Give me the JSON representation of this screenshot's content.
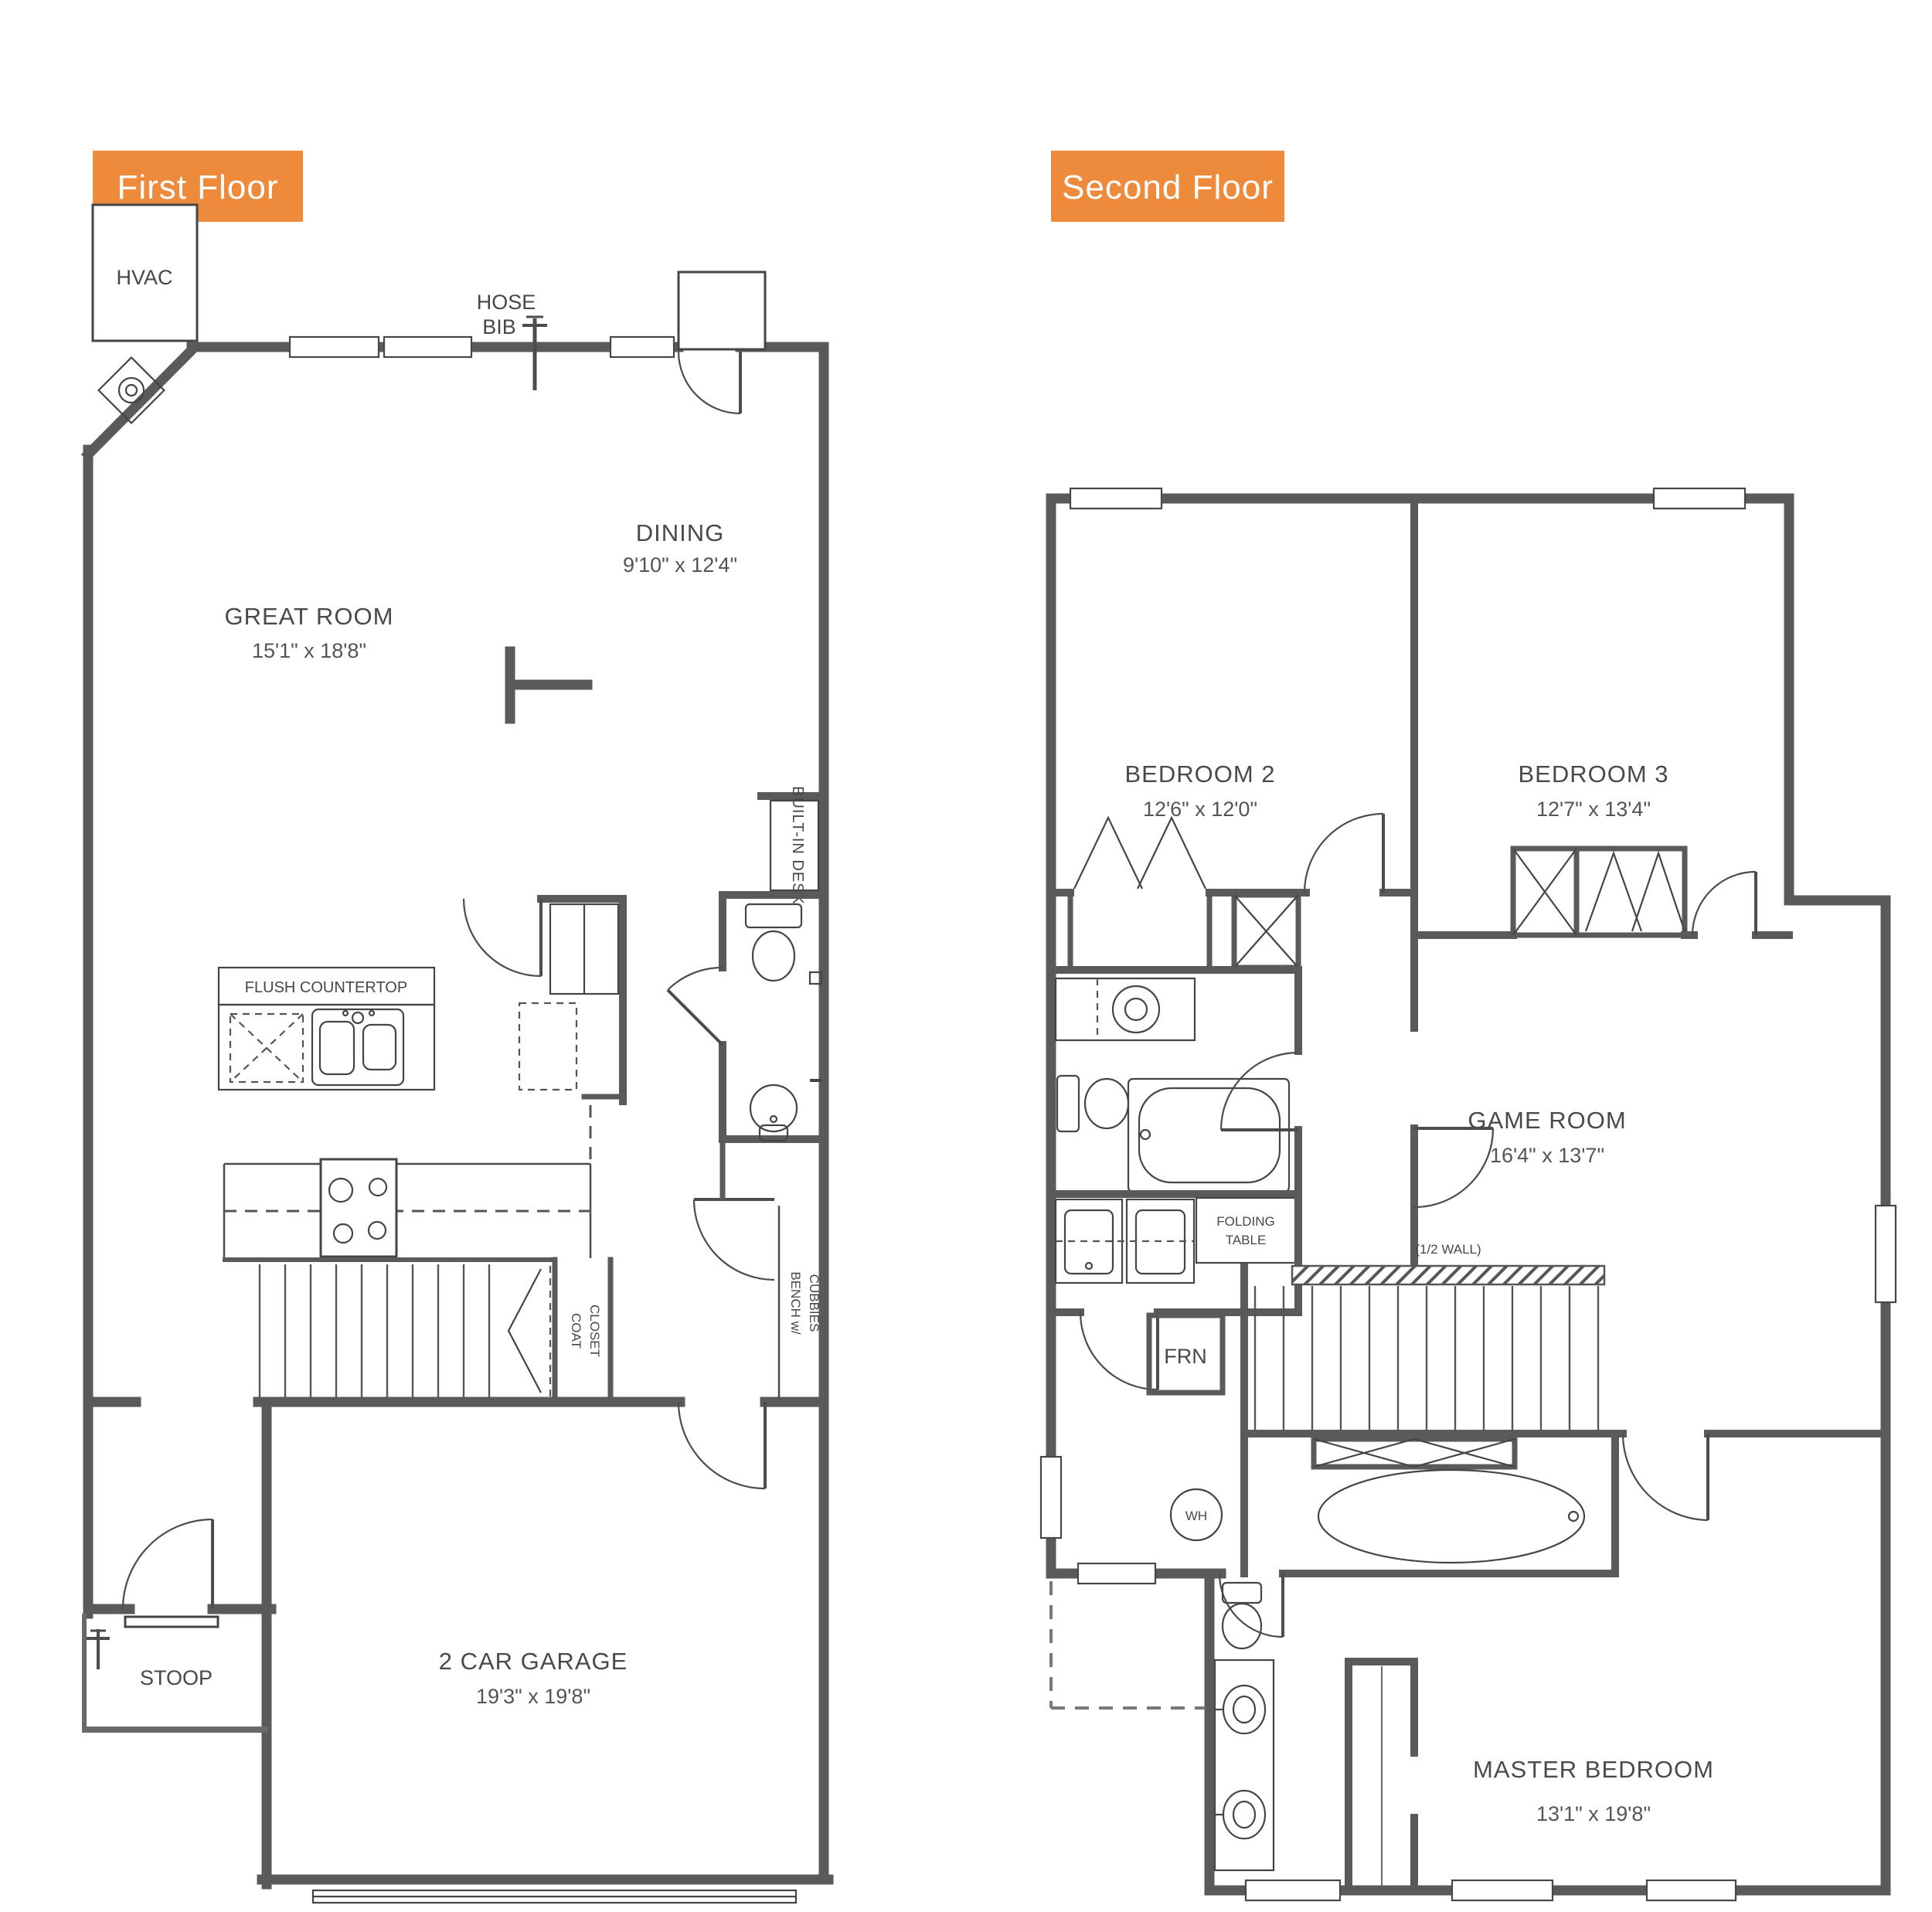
{
  "colors": {
    "accent": "#EE8A3B",
    "wall": "#5A5A5A",
    "text": "#4A4A4A"
  },
  "first_floor": {
    "badge": "First Floor",
    "hvac": "HVAC",
    "hose_bib": {
      "line1": "HOSE",
      "line2": "BIB"
    },
    "great_room": {
      "name": "GREAT ROOM",
      "dims": "15'1\" x 18'8\""
    },
    "dining": {
      "name": "DINING",
      "dims": "9'10\" x 12'4\""
    },
    "garage": {
      "name": "2 CAR GARAGE",
      "dims": "19'3\" x 19'8\""
    },
    "flush_countertop": "FLUSH COUNTERTOP",
    "built_in_desk": "BUILT-IN DESK",
    "coat_closet": {
      "line1": "COAT",
      "line2": "CLOSET"
    },
    "bench": {
      "line1": "BENCH w/",
      "line2": "CUBBIES"
    },
    "stoop": "STOOP"
  },
  "second_floor": {
    "badge": "Second Floor",
    "bedroom2": {
      "name": "BEDROOM 2",
      "dims": "12'6\" x 12'0\""
    },
    "bedroom3": {
      "name": "BEDROOM 3",
      "dims": "12'7\" x 13'4\""
    },
    "game_room": {
      "name": "GAME ROOM",
      "dims": "16'4\" x 13'7\""
    },
    "master": {
      "name": "MASTER BEDROOM",
      "dims": "13'1\" x 19'8\""
    },
    "folding_table": {
      "line1": "FOLDING",
      "line2": "TABLE"
    },
    "half_wall": "(1/2 WALL)",
    "furnace": "FRN",
    "water_heater": "WH"
  }
}
